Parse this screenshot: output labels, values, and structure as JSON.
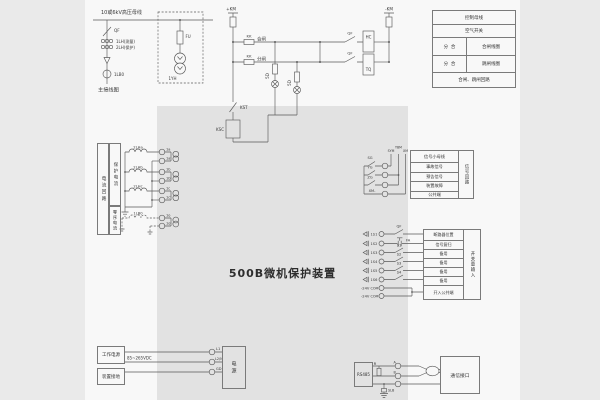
{
  "title": "500B微机保护装置",
  "colors": {
    "page": "#f8f8f8",
    "band": "#e2e2e2",
    "margin": "#eaeaea",
    "line": "#5a5a5a"
  },
  "main_diagram": {
    "bus_label": "10或6kV高压母线",
    "breaker": "QF",
    "ct_measure": "1LH(测量)",
    "ct_protect": "2LH(保护)",
    "ct_zero": "1LB0",
    "fuse": "FU",
    "pt": "1YH",
    "caption": "主接线图"
  },
  "control_circuit": {
    "bus_pos": "+KM",
    "bus_neg": "-KM",
    "kk_close": "KK",
    "close_label": "合闸",
    "kk_open": "KK",
    "open_label": "分闸",
    "aux_close": "QF",
    "aux_open": "QF",
    "close_coil": "HC",
    "trip_coil": "TQ",
    "lamp1": "5D",
    "lamp2": "5D",
    "kst": "KST",
    "ksc": "KSC"
  },
  "control_table": {
    "row1": "控制母线",
    "row2": "空气开关",
    "row3_left": "分  合",
    "row3_right": "合闸线圈",
    "row4_left": "分  合",
    "row4_right": "跳闸线圈",
    "row5": "合闸、跳闸回路"
  },
  "current_circuit": {
    "group": "电流回路",
    "protect": "保护电流",
    "zero": "零序电流",
    "coil_a": "2LHa",
    "coil_b": "2LHb",
    "coil_c": "2LHc",
    "coil_o": "1LB0",
    "t_a1": "1a",
    "t_a2": "1a′",
    "t_b1": "1b",
    "t_b2": "1b′",
    "t_c1": "1c",
    "t_c2": "1c′",
    "t_o1": "1o",
    "t_o2": "1o′"
  },
  "signal_circuit": {
    "bus1": "SYM",
    "bus2": "YBM",
    "bus3": "XM",
    "contact1": "SG",
    "contact2": "YG",
    "contact3": "ZG",
    "contact4": "XM-",
    "table_header": "信号小母线",
    "table_rows": [
      "事故信号",
      "预告信号",
      "装置故障",
      "公共端"
    ],
    "table_side": "信号回路"
  },
  "input_circuit": {
    "inputs": [
      "1S1",
      "1S2",
      "1S3",
      "1S4",
      "1S5",
      "1S6"
    ],
    "minus": "-24V",
    "com": "COM",
    "contacts": [
      "QF",
      "FA",
      "S1",
      "S2",
      "S3",
      "S4"
    ],
    "table_rows": [
      "断路器位置",
      "信号复归",
      "备用",
      "备用",
      "备用",
      "备用",
      "开入公共端"
    ],
    "table_side": "开关量输入"
  },
  "power": {
    "box_source": "工作电源",
    "box_ground": "装置接地",
    "voltage": "85~265VDC",
    "t1": "L1",
    "t2": "L2/N",
    "t3": "GD",
    "box_device": "电源"
  },
  "comm": {
    "box": "RS485",
    "resistor": "R",
    "ta": "A",
    "tb": "B",
    "slb": "SLB",
    "box_right": "通信接口"
  }
}
